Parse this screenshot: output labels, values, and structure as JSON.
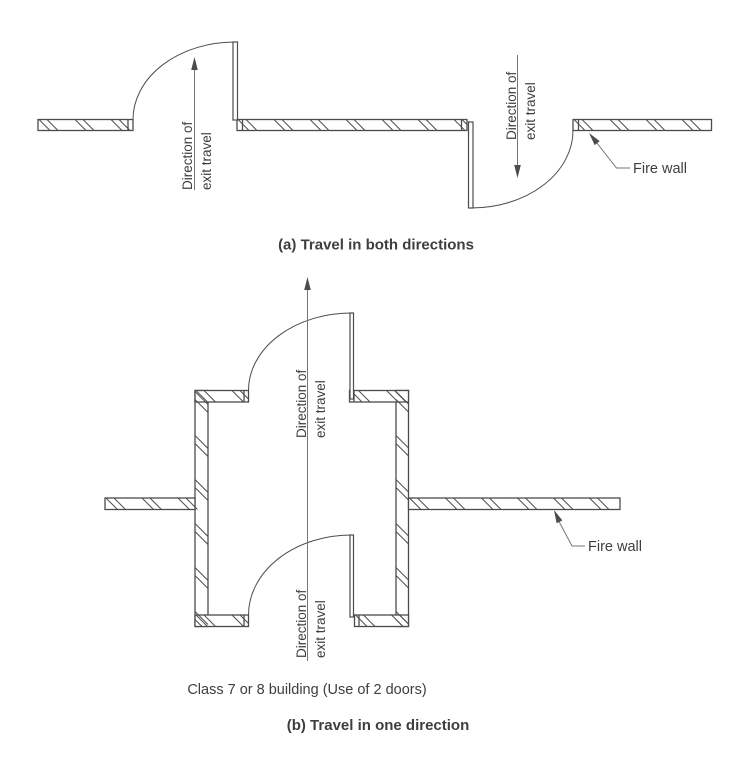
{
  "colors": {
    "wall_line": "#4c4c4c",
    "thin_line": "#767676",
    "text": "#3e3e3e",
    "background": "#ffffff"
  },
  "panel_a": {
    "caption": "(a) Travel in both directions",
    "left_door_direction": {
      "line1": "Direction of",
      "line2": "exit travel"
    },
    "right_door_direction": {
      "line1": "Direction of",
      "line2": "exit travel"
    },
    "fire_wall_label": "Fire wall"
  },
  "panel_b": {
    "caption": "(b) Travel in one direction",
    "note": "Class 7 or 8 building (Use of 2 doors)",
    "top_door_direction": {
      "line1": "Direction of",
      "line2": "exit travel"
    },
    "bottom_door_direction": {
      "line1": "Direction of",
      "line2": "exit travel"
    },
    "fire_wall_label": "Fire wall"
  }
}
